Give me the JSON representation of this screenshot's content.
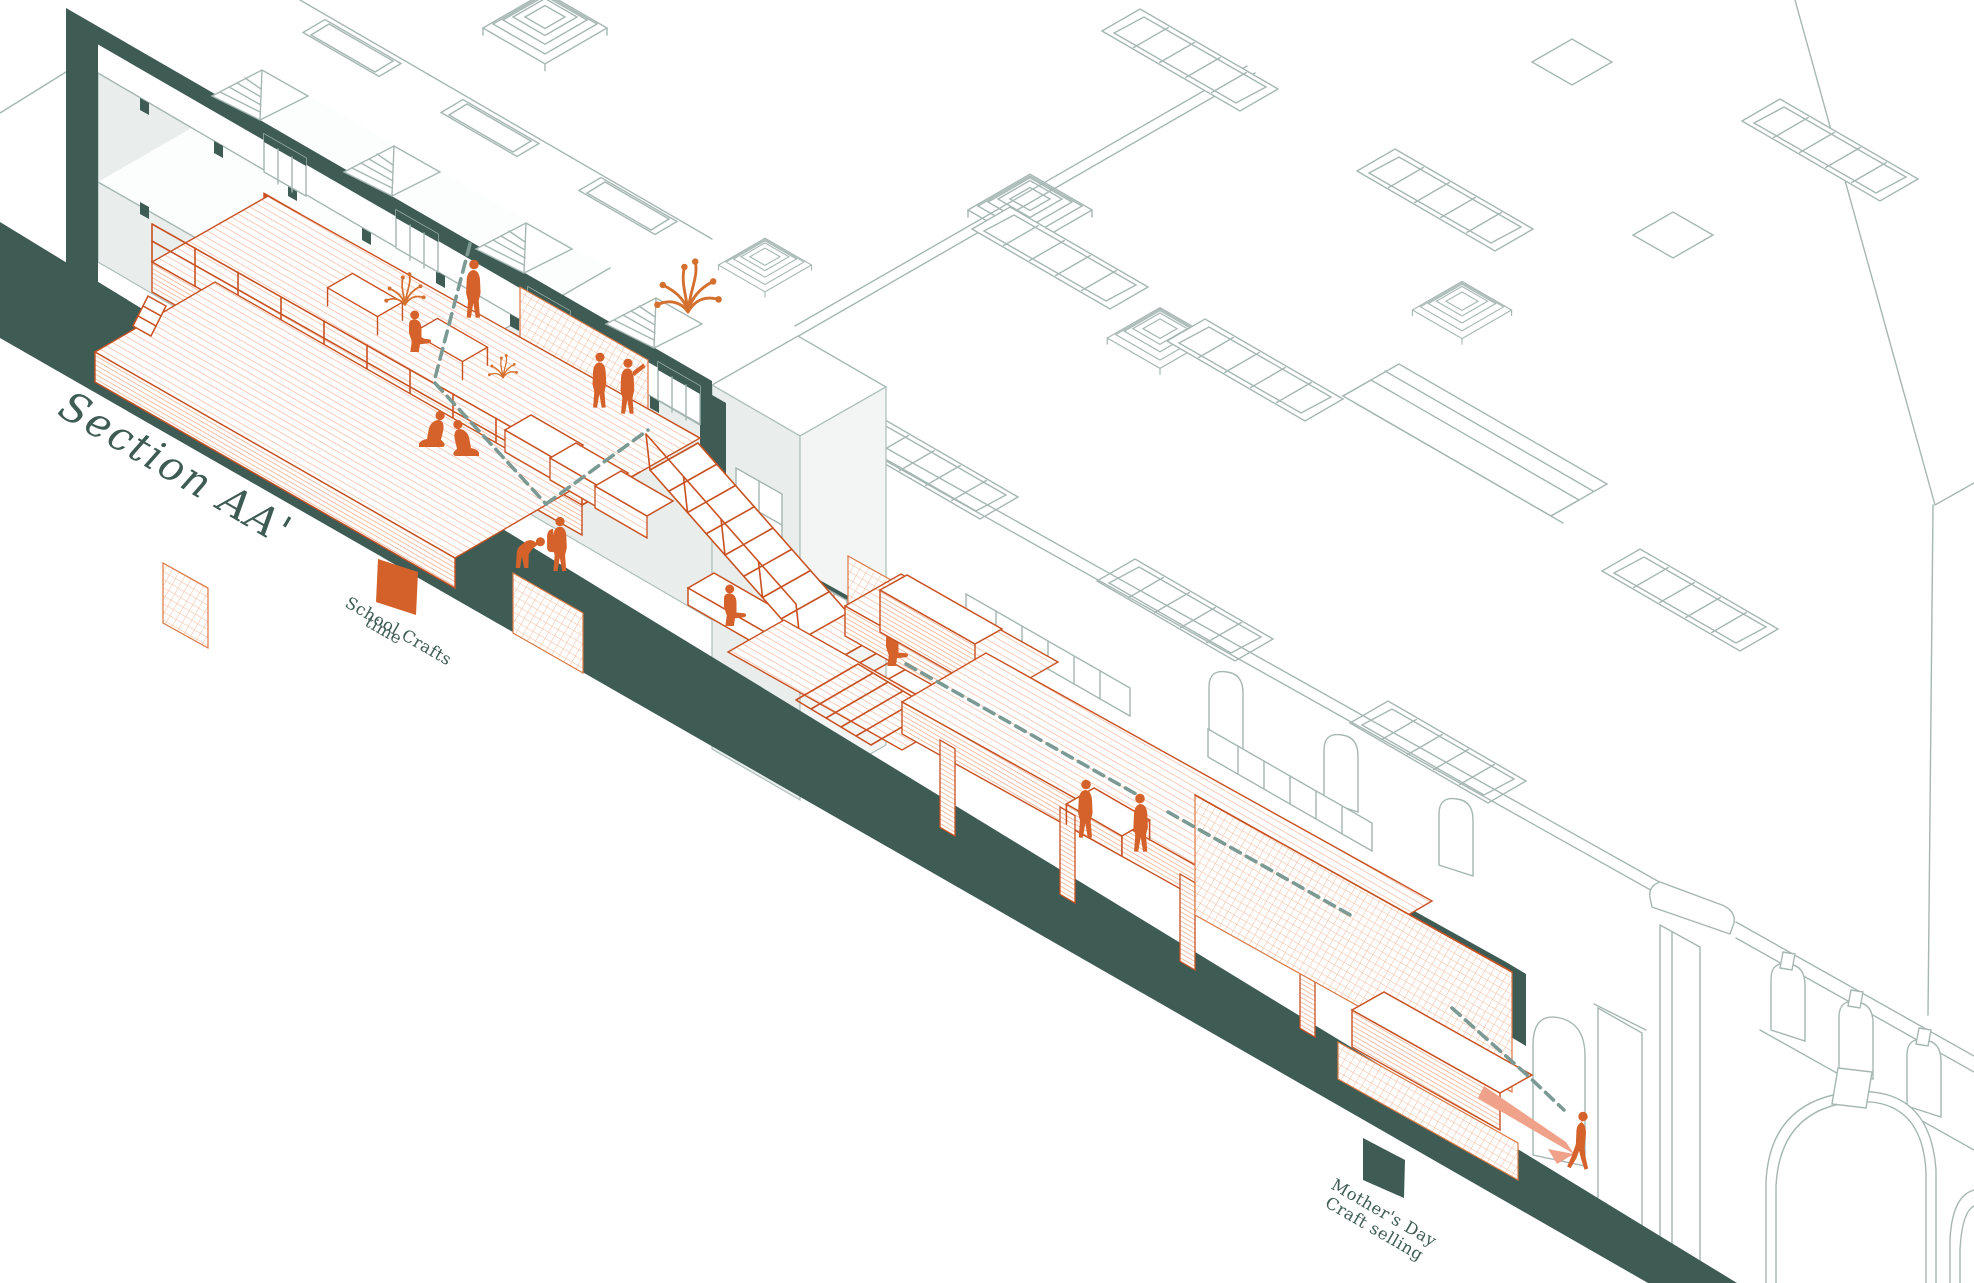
{
  "title": {
    "label": "Section AA'"
  },
  "legend": {
    "school_crafts": {
      "line1": "School Crafts",
      "line2": "time",
      "swatch_color": "#d4612a"
    },
    "mothers_day": {
      "line1": "Mother's Day",
      "line2": "Craft selling",
      "swatch_color": "#3e5b54"
    }
  },
  "palette": {
    "section_cut_teal": "#3e5b54",
    "activity_orange": "#d4612a",
    "orange_outline": "#c85122",
    "orange_hatch": "#f2a887",
    "building_line_gray": "#a6b7b3",
    "wall_fill_gray": "#e9eeec",
    "sightline_dash_teal": "#7c9a94",
    "arrow_salmon": "#efa289",
    "background": "#ffffff"
  },
  "scene": {
    "zone_figures": {
      "school_crafts_time": 9,
      "mothers_day_craft_selling": 6
    }
  }
}
